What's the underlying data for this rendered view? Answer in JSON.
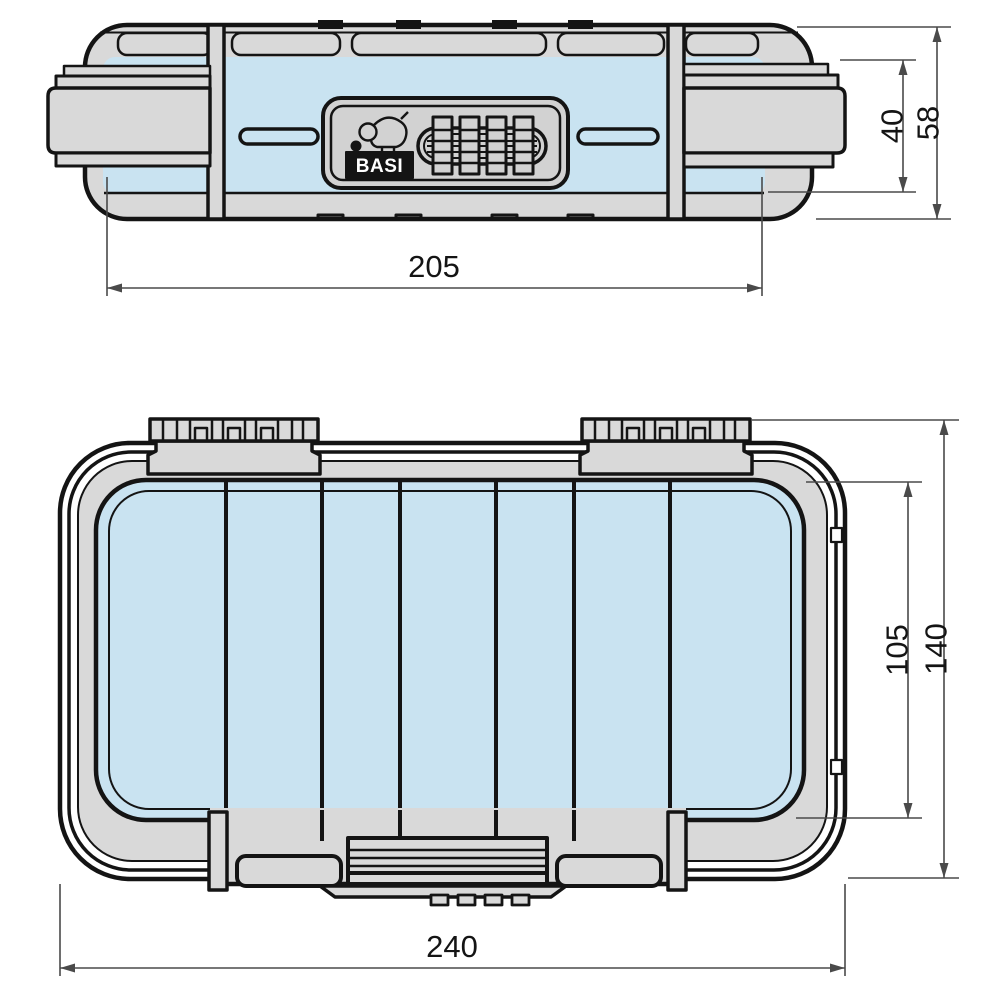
{
  "colors": {
    "line": "#141414",
    "body_gray": "#d9d9d9",
    "panel_gray": "#d2d2d2",
    "interior_blue": "#c9e3f1",
    "dimension_line": "#4a4a4a",
    "text": "#141414",
    "background": "#ffffff"
  },
  "front_view": {
    "dim_width": "205",
    "dim_inner_height": "40",
    "dim_outer_height": "58",
    "brand_label": "BASI"
  },
  "plan_view": {
    "dim_width": "240",
    "dim_inner_depth": "105",
    "dim_outer_depth": "140"
  }
}
